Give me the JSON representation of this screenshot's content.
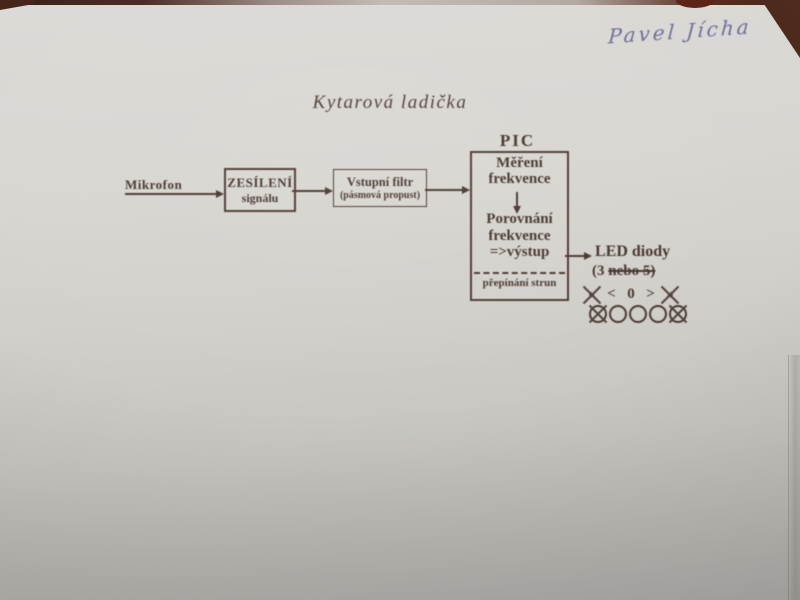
{
  "handwriting": {
    "name": "Pavel Jícha"
  },
  "title": "Kytarová ladička",
  "diagram": {
    "mikrofon_label": "Mikrofon",
    "amplifier": {
      "line1": "ZESÍLENÍ",
      "line2": "signálu"
    },
    "filter": {
      "line1": "Vstupní filtr",
      "line2": "(pásmová propust)"
    },
    "pic": {
      "title": "PIC",
      "block1": {
        "line1": "Měření",
        "line2": "frekvence"
      },
      "block2": {
        "line1": "Porovnání",
        "line2": "frekvence",
        "line3": "=>výstup"
      },
      "footer": "přepínání strun"
    },
    "led": {
      "title": "LED diody",
      "count_prefix": "(3 ",
      "count_struck": "nebo 5)",
      "symbols": [
        "«",
        "<",
        "0",
        ">",
        "»"
      ],
      "circle_count": 5
    }
  },
  "colors": {
    "ink": "#4a3832",
    "paper_top": "#dcdad6",
    "paper_bottom": "#adacaa",
    "handwriting_blue": "#575b90",
    "table_brown": "#4a2a20"
  }
}
